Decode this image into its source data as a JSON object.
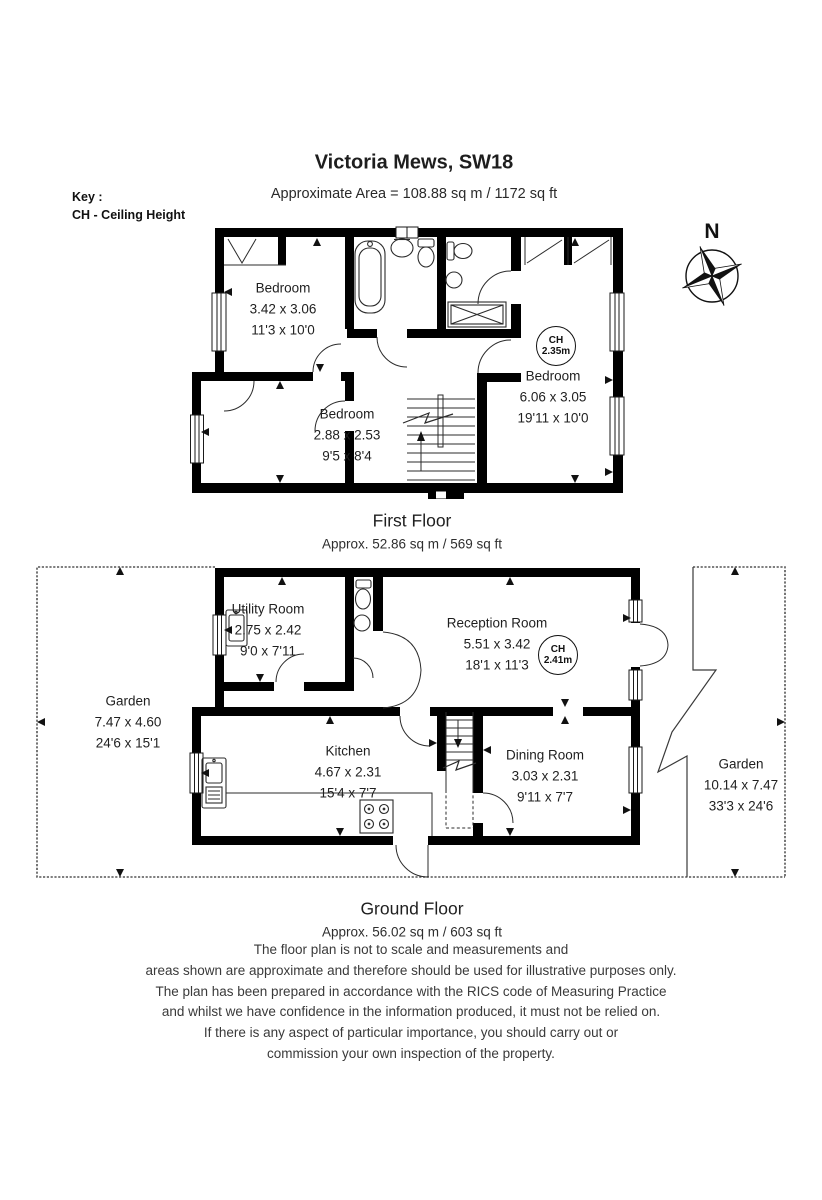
{
  "header": {
    "title": "Victoria Mews, SW18",
    "area_line": "Approximate Area =  108.88 sq m / 1172 sq ft"
  },
  "key": {
    "title": "Key :",
    "entry": "CH - Ceiling Height"
  },
  "compass": {
    "north_label": "N"
  },
  "first_floor": {
    "caption": "First Floor",
    "area_caption": "Approx. 52.86 sq m / 569 sq ft",
    "rooms": [
      {
        "name": "Bedroom",
        "metric": "3.42 x 3.06",
        "imperial": "11'3 x 10'0"
      },
      {
        "name": "Bedroom",
        "metric": "2.88 x 2.53",
        "imperial": "9'5 x 8'4"
      },
      {
        "name": "Bedroom",
        "metric": "6.06 x 3.05",
        "imperial": "19'11 x 10'0"
      }
    ],
    "ceiling_height": {
      "label": "CH",
      "value": "2.35m"
    }
  },
  "ground_floor": {
    "caption": "Ground Floor",
    "area_caption": "Approx. 56.02 sq m / 603 sq ft",
    "rooms": [
      {
        "name": "Utility Room",
        "metric": "2.75 x 2.42",
        "imperial": "9'0 x 7'11"
      },
      {
        "name": "Reception Room",
        "metric": "5.51 x 3.42",
        "imperial": "18'1 x 11'3"
      },
      {
        "name": "Kitchen",
        "metric": "4.67 x 2.31",
        "imperial": "15'4 x 7'7"
      },
      {
        "name": "Dining Room",
        "metric": "3.03 x 2.31",
        "imperial": "9'11 x 7'7"
      },
      {
        "name": "Garden",
        "metric": "7.47 x 4.60",
        "imperial": "24'6 x 15'1"
      },
      {
        "name": "Garden",
        "metric": "10.14 x 7.47",
        "imperial": "33'3 x 24'6"
      }
    ],
    "ceiling_height": {
      "label": "CH",
      "value": "2.41m"
    }
  },
  "disclaimer": {
    "lines": [
      "The floor plan is not to scale and measurements and",
      "areas shown are approximate and therefore should be used for illustrative purposes only.",
      "The plan has been prepared in accordance with the RICS code of Measuring Practice",
      "and whilst we have confidence in the information produced, it must not be relied on.",
      "If there is any aspect of particular importance, you should carry out or",
      "commission your own inspection of the property."
    ]
  },
  "colors": {
    "wall": "#000000",
    "line": "#2b2b2b",
    "text": "#1f1f1f",
    "disclaimer_text": "#3a3a3a",
    "background": "#ffffff"
  }
}
